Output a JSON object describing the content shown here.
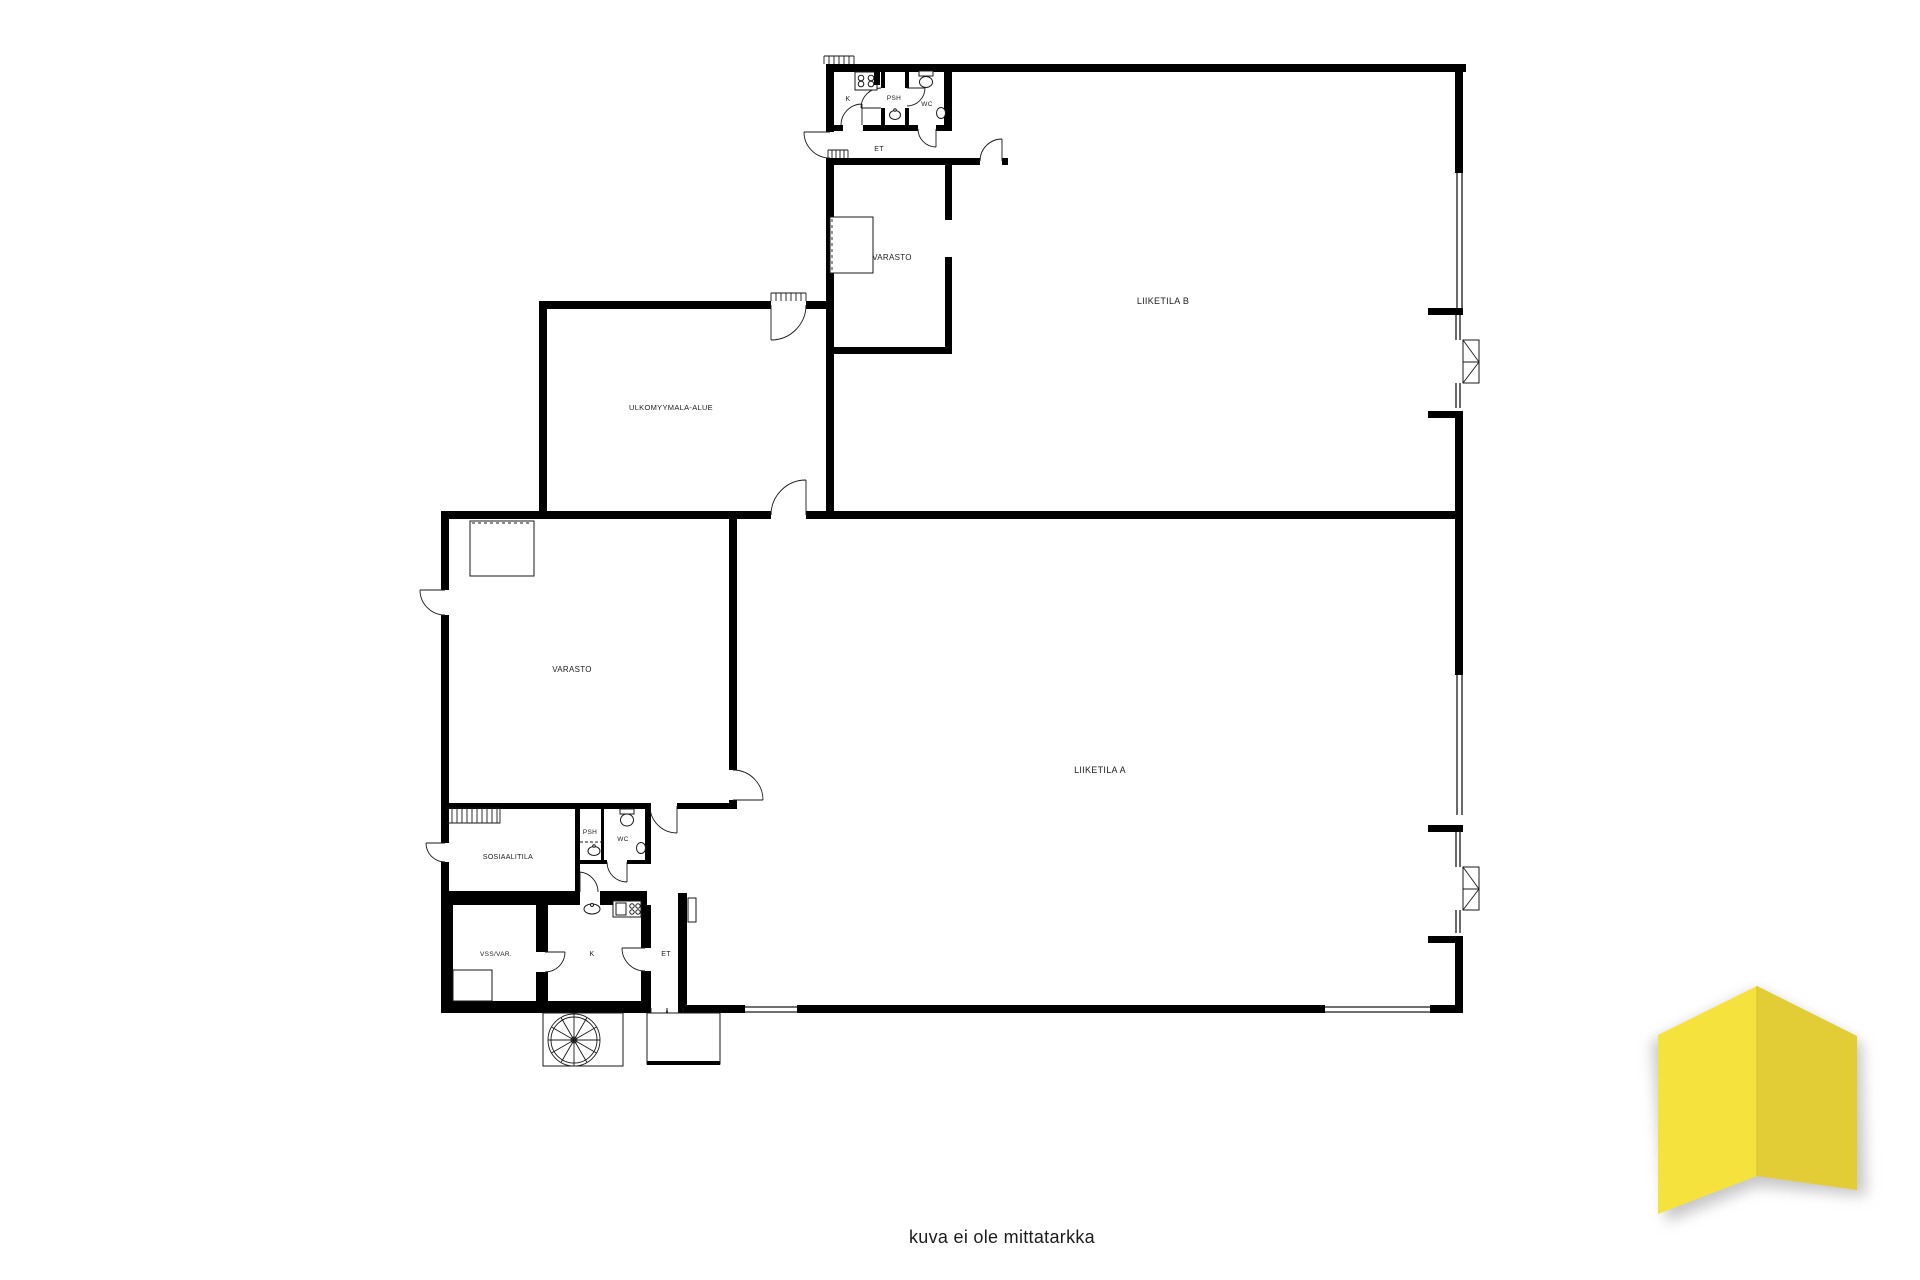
{
  "page": {
    "background": "#ffffff",
    "caption": "kuva ei ole mittatarkka"
  },
  "plan": {
    "wall_color": "#000000",
    "rooms": {
      "liiketila_a": "LIIKETILA A",
      "liiketila_b": "LIIKETILA B",
      "varasto_top": "VARASTO",
      "varasto_left": "VARASTO",
      "ulkomyymala_alue": "ULKOMYYMALA-ALUE",
      "sosiaalitila": "SOSIAALITILA",
      "vss_var": "VSS/VAR.",
      "k_top": "K",
      "k_bottom": "K",
      "psh_top": "PSH",
      "psh_bottom": "PSH",
      "wc_top": "WC",
      "wc_bottom": "WC",
      "et_top": "ET",
      "et_bottom": "ET"
    },
    "icons": {
      "stove": "stove-icon",
      "toilet": "toilet-icon",
      "sink": "sink-icon",
      "spiral_staircase": "spiral-staircase-icon",
      "door_swing": "door-swing-icon",
      "window": "window-icon",
      "lockers": "locker-comb-icon"
    }
  },
  "logo": {
    "left_panel_color": "#F5E23D",
    "right_panel_color": "#E2CD37",
    "shadow_color": "#8f8f8f"
  }
}
